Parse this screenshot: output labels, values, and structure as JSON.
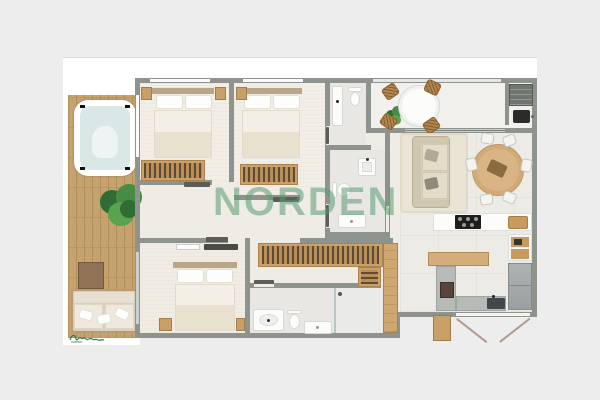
{
  "watermark": {
    "text": "NORDEN"
  },
  "palette": {
    "background": "#ededed",
    "mat": "#ffffff",
    "wall": "#8e938e",
    "unit_floor": "#efece6",
    "deck_wood": "#c6a26f",
    "furniture_wood": "#caa269",
    "watermark_green": "rgba(88,157,113,0.55)",
    "signature_green": "#2f7d3e",
    "plant_green": "#3f8a42",
    "hot_tub_water": "#d9e8e6",
    "cooktop_black": "#1c1c1c",
    "appliance_gray": "#a7abab"
  },
  "furniture_icons": [
    "hot-tub-icon",
    "potted-plant-icon",
    "outdoor-sofa-icon",
    "side-cube-icon",
    "double-bed-icon",
    "nightstand-icon",
    "dresser-icon",
    "wardrobe-icon",
    "toilet-icon",
    "sink-icon",
    "square-sink-icon",
    "shower-tray-icon",
    "sofa-icon",
    "rug-icon",
    "dining-table-icon",
    "dining-chair-icon",
    "round-table-icon",
    "wicker-chair-icon",
    "grill-icon",
    "outdoor-sink-icon",
    "cooktop-icon",
    "kitchen-island-icon",
    "kitchen-sink-icon",
    "fridge-icon",
    "coffee-tower-icon",
    "tv-icon",
    "soundbar-icon",
    "entry-door-icon",
    "door-swing-icon"
  ]
}
